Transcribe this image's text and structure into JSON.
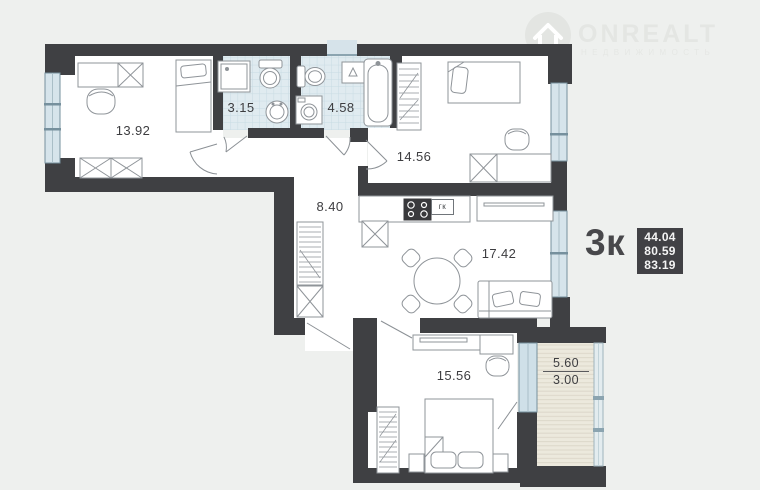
{
  "logo": {
    "brand": "ONREALT",
    "tagline": "НЕДВИЖИМОСТЬ"
  },
  "apartment": {
    "type_label": "3к",
    "area_values": [
      "44.04",
      "80.59",
      "83.19"
    ]
  },
  "rooms": {
    "bedroom1": "13.92",
    "bath1": "3.15",
    "bath2": "4.58",
    "bedroom2": "14.56",
    "hall": "8.40",
    "kitchen": "17.42",
    "bedroom3": "15.56",
    "balcony_full": "5.60",
    "balcony_reduced": "3.00",
    "boiler_label": "гк"
  }
}
